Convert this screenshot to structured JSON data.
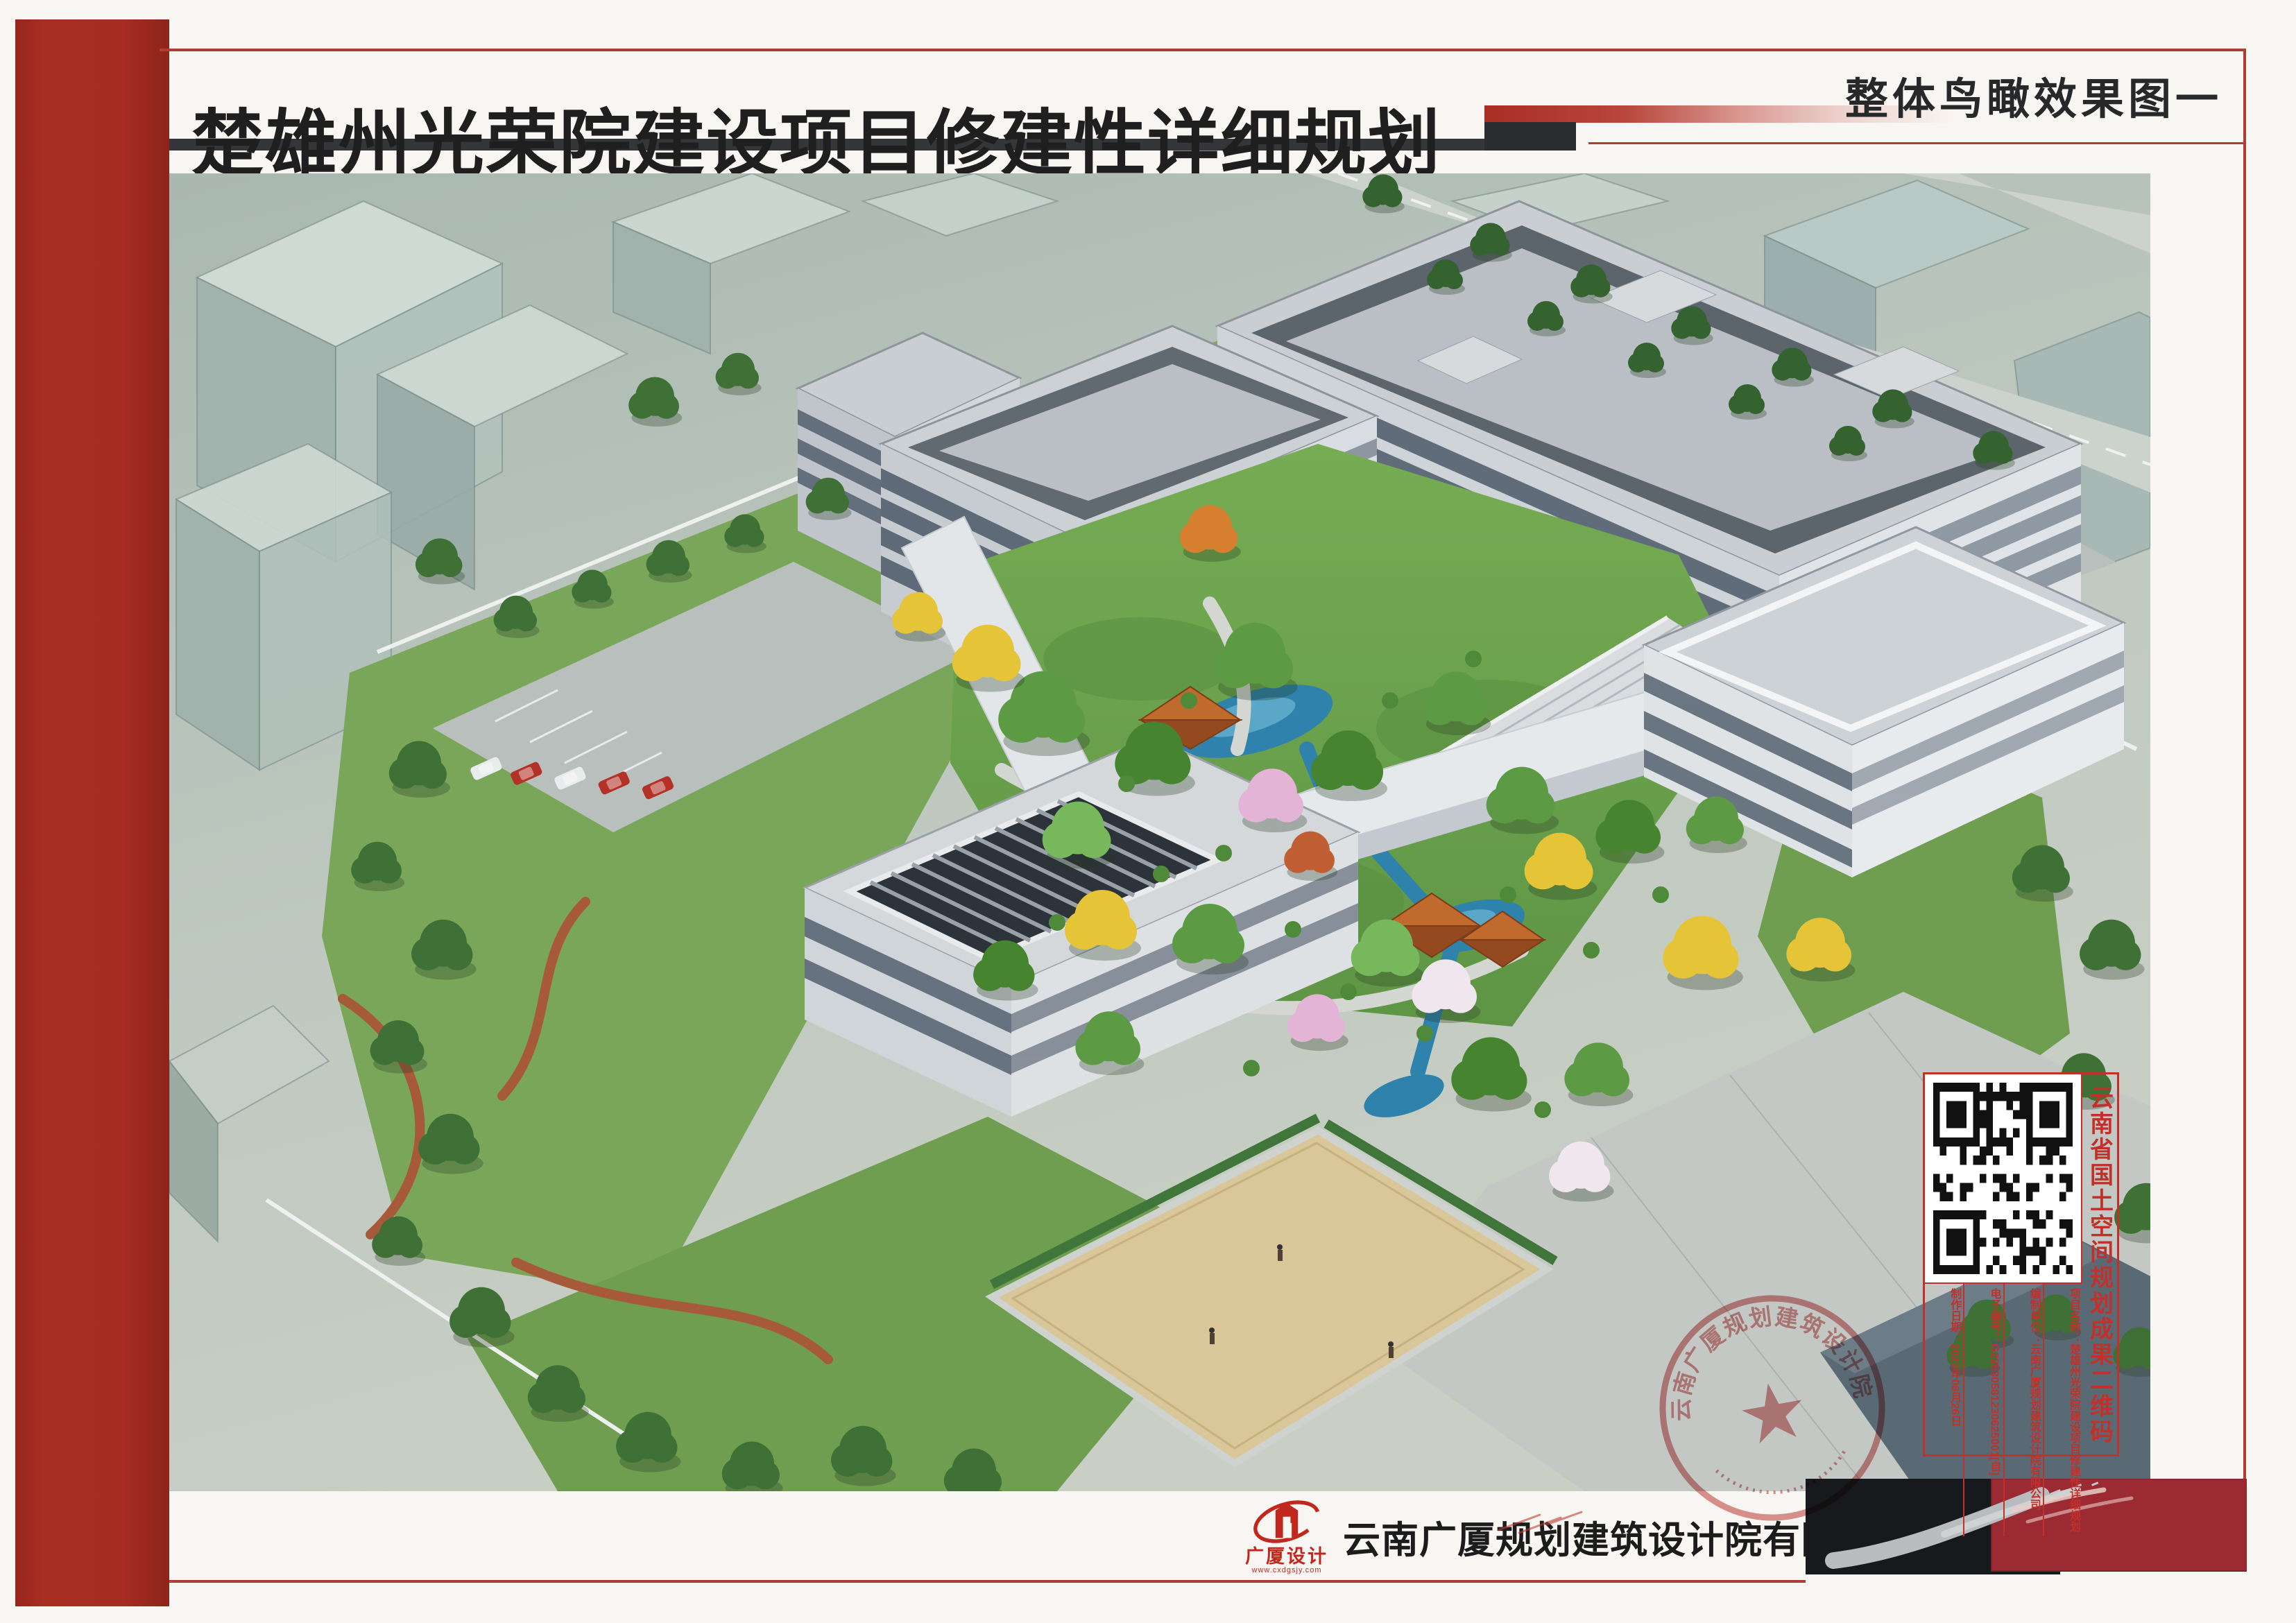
{
  "header": {
    "title": "楚雄州光荣院建设项目修建性详细规划",
    "view_label": "整体鸟瞰效果图一"
  },
  "rendering": {
    "alt": "光荣院项目整体鸟瞰效果图：白色多层建筑围合中央庭院花园，含水景、凉亭、前广场与周边绿化道路"
  },
  "stamp": {
    "qr_label": "云南省国土空间规划成果二维码",
    "fields": [
      "制作日期：2023年06月26日",
      "电子编号：G22530581230625001[自]",
      "编制单位：云南广厦规划建筑设计院有限公司",
      "项目名称：楚雄州光荣院建设项目修建性详细规划"
    ]
  },
  "seal": {
    "company": "云南广厦规划建筑设计院有限公司"
  },
  "footer": {
    "logo_text": "广厦设计",
    "logo_url": "www.cxdgsjy.com",
    "company": "云南广厦规划建筑设计院有限公司"
  },
  "colors": {
    "accent_red": "#a52d22",
    "stamp_red": "#c2302a",
    "title_bar_dark": "#34363a",
    "deep_red_block": "#9c2a33"
  }
}
